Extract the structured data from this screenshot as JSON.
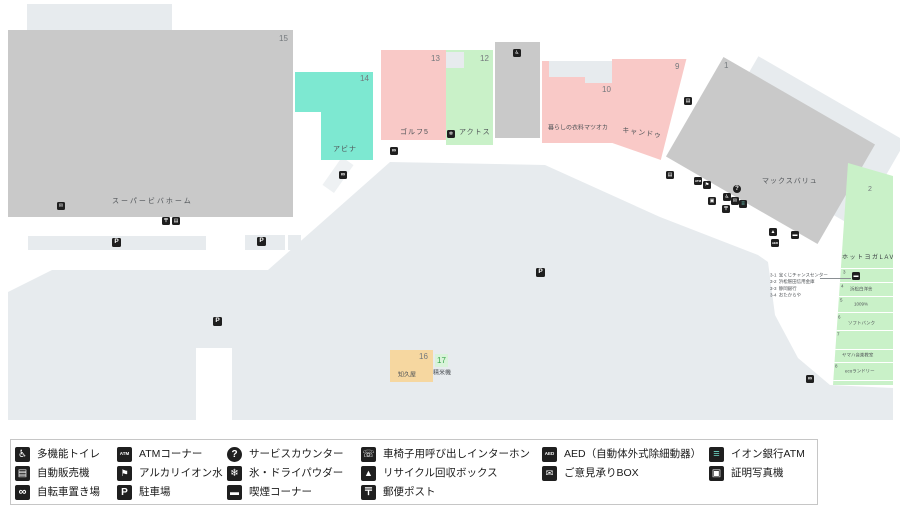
{
  "map": {
    "stores": {
      "viva": {
        "no": "15",
        "name": "スーパービバホーム"
      },
      "abina": {
        "no": "14",
        "name": "アビナ"
      },
      "golf5": {
        "no": "13",
        "name": "ゴルフ5"
      },
      "actos": {
        "no": "12",
        "name": "アクトス"
      },
      "matsuoka": {
        "no": "10",
        "name": "暮らしの衣料マツオカ"
      },
      "cando": {
        "no": "9",
        "name": "キャンドゥ"
      },
      "maxvalu": {
        "no": "1",
        "name": "マックスバリュ"
      },
      "lava": {
        "no": "2",
        "name": "ホットヨガLAVA"
      },
      "chikuya": {
        "no": "16",
        "name": "知久屋"
      },
      "seimaiki": {
        "no": "17",
        "name": "精米機"
      }
    },
    "lava_strip": {
      "dividers_y": [
        108,
        122,
        136,
        152,
        170,
        189,
        202,
        220
      ],
      "sections": [
        {
          "no": "3",
          "no_x": 17,
          "no_y": 110
        },
        {
          "no": "4",
          "no_x": 15,
          "no_y": 124,
          "label": "浜松白洋舎",
          "label_x": 24,
          "label_y": 127
        },
        {
          "no": "5",
          "no_x": 14,
          "no_y": 138,
          "label": "1009%",
          "label_x": 28,
          "label_y": 142
        },
        {
          "no": "6",
          "no_x": 12,
          "no_y": 155,
          "label": "ソフトバンク",
          "label_x": 22,
          "label_y": 161
        },
        {
          "no": "7",
          "no_x": 11,
          "no_y": 172
        },
        {
          "no": "",
          "no_x": 0,
          "no_y": 0,
          "label": "ヤマハ音楽教室",
          "label_x": 16,
          "label_y": 193
        },
        {
          "no": "8",
          "no_x": 9,
          "no_y": 204,
          "label": "ecoランドリー",
          "label_x": 19,
          "label_y": 209
        }
      ]
    },
    "annotations": [
      {
        "no": "3-1",
        "name": "宝くじチャンスセンター"
      },
      {
        "no": "3-2",
        "name": "浜松磐田信用金庫"
      },
      {
        "no": "3-3",
        "name": "静岡銀行"
      },
      {
        "no": "3-4",
        "name": "おたからや"
      }
    ],
    "icon_defs": {
      "toilet": {
        "glyph": "♿",
        "m": 5,
        "l": 10
      },
      "vending": {
        "glyph": "▤",
        "m": 5,
        "l": 10
      },
      "bicycle": {
        "glyph": "∞",
        "m": 6,
        "l": 11
      },
      "atm": {
        "glyph": "ATM",
        "m": 3,
        "l": 4.5
      },
      "alkaline-water": {
        "glyph": "⚑",
        "m": 5,
        "l": 9
      },
      "parking": {
        "glyph": "P",
        "m": 6.5,
        "l": 10
      },
      "service": {
        "glyph": "?",
        "m": 6,
        "l": 10,
        "circle": true
      },
      "ice": {
        "glyph": "❄",
        "m": 5,
        "l": 10
      },
      "smoking": {
        "glyph": "▬",
        "m": 5,
        "l": 9
      },
      "intercom": {
        "glyph": "☏",
        "m": 5,
        "l": 10
      },
      "recycle": {
        "glyph": "▲",
        "m": 5,
        "l": 9
      },
      "post": {
        "glyph": "〒",
        "m": 5,
        "l": 10
      },
      "aed": {
        "glyph": "AED",
        "m": 3,
        "l": 4.5
      },
      "suggestion-box": {
        "glyph": "✉",
        "m": 5,
        "l": 9
      },
      "aeon-atm": {
        "glyph": "≡",
        "m": 6,
        "l": 11,
        "color": "#6fd8c6"
      },
      "photo": {
        "glyph": "▣",
        "m": 5,
        "l": 10
      },
      "lottery": {
        "glyph": "▬",
        "m": 5,
        "l": 8
      }
    },
    "icons": [
      {
        "type": "suggestion-box",
        "x": 57,
        "y": 202
      },
      {
        "type": "post",
        "x": 162,
        "y": 217
      },
      {
        "type": "vending",
        "x": 172,
        "y": 217
      },
      {
        "type": "parking",
        "x": 112,
        "y": 238
      },
      {
        "type": "parking",
        "x": 257,
        "y": 237
      },
      {
        "type": "parking",
        "x": 213,
        "y": 317
      },
      {
        "type": "parking",
        "x": 536,
        "y": 268
      },
      {
        "type": "bicycle",
        "x": 339,
        "y": 171
      },
      {
        "type": "bicycle",
        "x": 390,
        "y": 147
      },
      {
        "type": "ice",
        "x": 447,
        "y": 130
      },
      {
        "type": "toilet",
        "x": 513,
        "y": 49
      },
      {
        "type": "vending",
        "x": 684,
        "y": 97
      },
      {
        "type": "vending",
        "x": 666,
        "y": 171
      },
      {
        "type": "atm",
        "x": 694,
        "y": 177
      },
      {
        "type": "alkaline-water",
        "x": 703,
        "y": 181
      },
      {
        "type": "service",
        "x": 733,
        "y": 185
      },
      {
        "type": "toilet",
        "x": 723,
        "y": 193
      },
      {
        "type": "photo",
        "x": 708,
        "y": 197
      },
      {
        "type": "suggestion-box",
        "x": 731,
        "y": 197
      },
      {
        "type": "aeon-atm",
        "x": 739,
        "y": 200
      },
      {
        "type": "post",
        "x": 722,
        "y": 205
      },
      {
        "type": "recycle",
        "x": 769,
        "y": 228
      },
      {
        "type": "smoking",
        "x": 791,
        "y": 231
      },
      {
        "type": "aed",
        "x": 771,
        "y": 239
      },
      {
        "type": "bicycle",
        "x": 806,
        "y": 375
      },
      {
        "type": "lottery",
        "x": 852,
        "y": 272
      }
    ]
  },
  "legend": {
    "items": [
      {
        "x": 4,
        "y": 7,
        "type": "toilet",
        "label": "多機能トイレ"
      },
      {
        "x": 4,
        "y": 26,
        "type": "vending",
        "label": "自動販売機"
      },
      {
        "x": 4,
        "y": 45,
        "type": "bicycle",
        "label": "自転車置き場"
      },
      {
        "x": 106,
        "y": 7,
        "type": "atm",
        "label": "ATMコーナー"
      },
      {
        "x": 106,
        "y": 26,
        "type": "alkaline-water",
        "label": "アルカリイオン水"
      },
      {
        "x": 106,
        "y": 45,
        "type": "parking",
        "label": "駐車場"
      },
      {
        "x": 216,
        "y": 7,
        "type": "service",
        "label": "サービスカウンター"
      },
      {
        "x": 216,
        "y": 26,
        "type": "ice",
        "label": "氷・ドライパウダー"
      },
      {
        "x": 216,
        "y": 45,
        "type": "smoking",
        "label": "喫煙コーナー"
      },
      {
        "x": 350,
        "y": 7,
        "type": "intercom",
        "label": "車椅子用呼び出しインターホン"
      },
      {
        "x": 350,
        "y": 26,
        "type": "recycle",
        "label": "リサイクル回収ボックス"
      },
      {
        "x": 350,
        "y": 45,
        "type": "post",
        "label": "郵便ポスト"
      },
      {
        "x": 531,
        "y": 7,
        "type": "aed",
        "label": "AED（自動体外式除細動器）"
      },
      {
        "x": 531,
        "y": 26,
        "type": "suggestion-box",
        "label": "ご意見承りBOX"
      },
      {
        "x": 698,
        "y": 7,
        "type": "aeon-atm",
        "label": "イオン銀行ATM"
      },
      {
        "x": 698,
        "y": 26,
        "type": "photo",
        "label": "証明写真機"
      }
    ]
  },
  "colors": {
    "area_light": "#e7ebee",
    "store_gray": "#c9c9c9",
    "store_pink": "#f9c9c7",
    "store_mint": "#7de8d1",
    "store_green": "#c9f1c8",
    "store_tan": "#f6d7a0",
    "icon_black": "#1f1f1f",
    "aeon_teal": "#6fd8c6",
    "seimaiki_green": "#3aa64c"
  }
}
